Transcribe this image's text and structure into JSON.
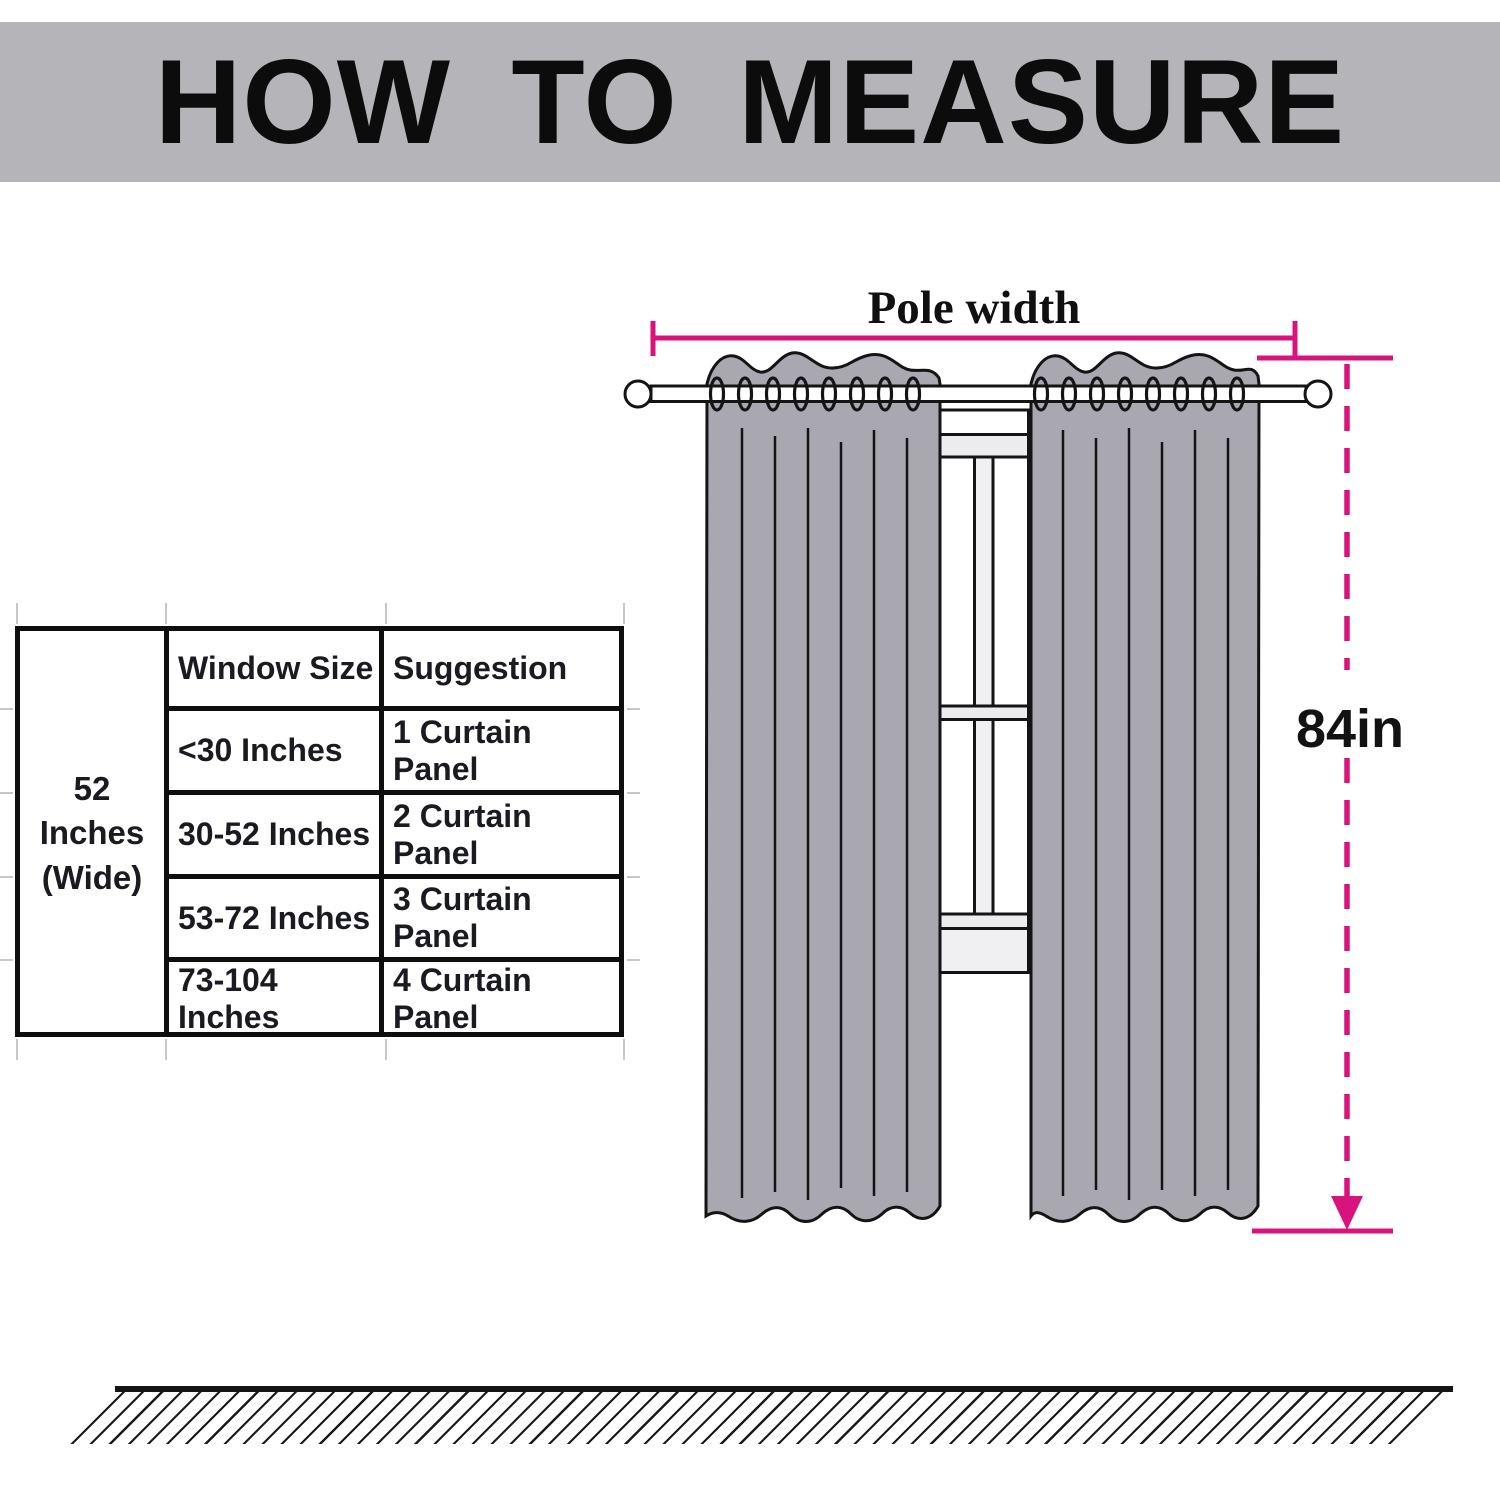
{
  "header": {
    "title": "HOW TO MEASURE"
  },
  "size_table": {
    "width_label_line1": "52 Inches",
    "width_label_line2": "(Wide)",
    "columns": [
      "Window Size",
      "Suggestion"
    ],
    "rows": [
      {
        "window_size": "<30 Inches",
        "suggestion": "1 Curtain Panel"
      },
      {
        "window_size": "30-52 Inches",
        "suggestion": "2 Curtain Panel"
      },
      {
        "window_size": "53-72 Inches",
        "suggestion": "3 Curtain Panel"
      },
      {
        "window_size": "73-104 Inches",
        "suggestion": "4 Curtain Panel"
      }
    ]
  },
  "diagram": {
    "pole_width_label": "Pole width",
    "curtain_length_label": "84in",
    "colors": {
      "measurement_pink": "#D8137E",
      "curtain_gray": "#A9A8B0",
      "banner_gray": "#B5B4B9",
      "outline_black": "#141414",
      "window_trim_gray": "#ECECEF"
    }
  }
}
